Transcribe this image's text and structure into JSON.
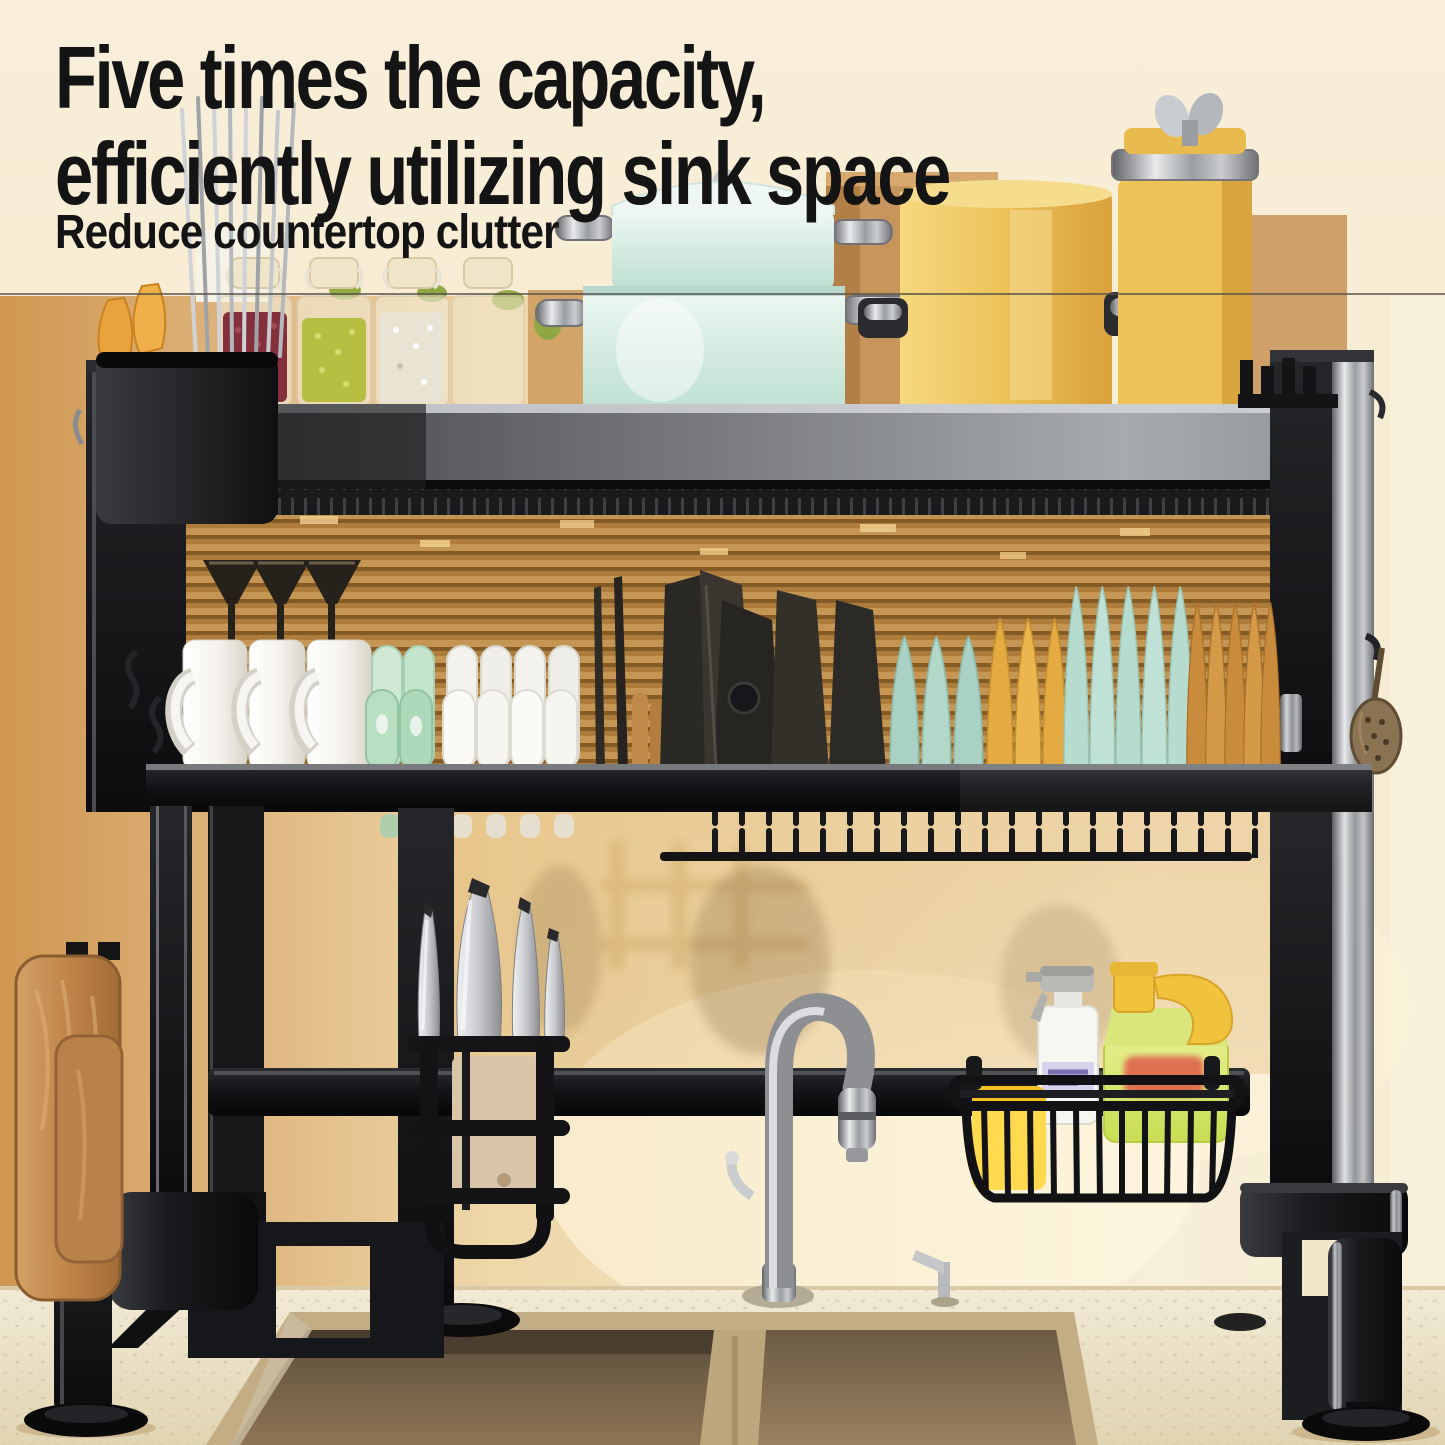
{
  "overlay": {
    "headline_line1": "Five times the capacity,",
    "headline_line2": "efficiently utilizing sink space",
    "subheadline": "Reduce countertop clutter"
  },
  "palette": {
    "canvas_cream": "#f6ead0",
    "wall_tan": "#d09751",
    "blinds_amber": "#c08a42",
    "rack_black": "#141416",
    "rail_silver": "#9a9da1",
    "pot_mint": "#d5ebe2",
    "pot_yellow": "#edc45c",
    "jar_red_beans": "#84303c",
    "jar_green_beans": "#b7bf42",
    "plate_teal": "#b6dccf",
    "plate_yellow": "#e3ab41",
    "plate_amber": "#c98c3c",
    "mug_white": "#f4f2ec",
    "bowl_green": "#cfe9d4",
    "wood_brown": "#c08449",
    "sponge_yellow": "#ffd94e",
    "detergent_green": "#cddf60",
    "sink_bronze": "#6e5c44",
    "counter_cream": "#e9dfc2",
    "divider_line": "#55504a",
    "headline_text": "#141414"
  }
}
